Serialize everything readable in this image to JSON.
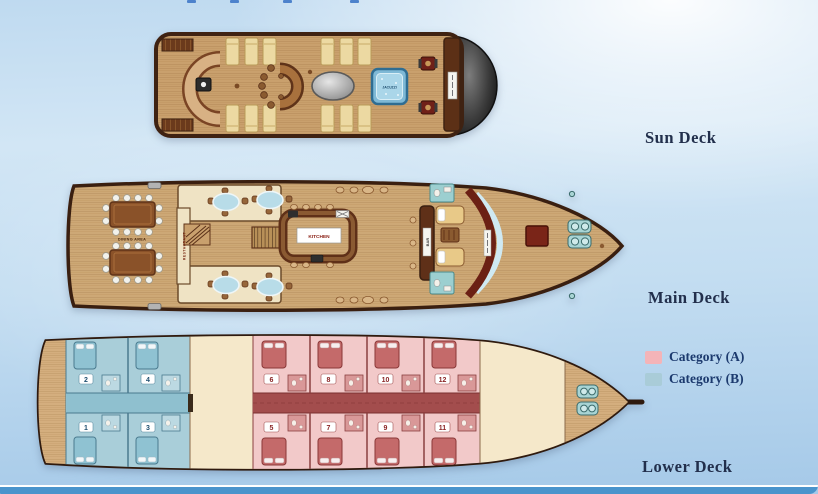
{
  "page": {
    "bottom_bar_color": "#4a94cc",
    "background_top": "#d2e6f5",
    "background_bottom": "#a5c9e8"
  },
  "legend": {
    "items": [
      {
        "label": "Category (A)",
        "color": "#f4b4b8"
      },
      {
        "label": "Category (B)",
        "color": "#a9ccd8"
      }
    ]
  },
  "decks": {
    "sun": {
      "label": "Sun Deck",
      "jacuzzi_label": "JACUZZI"
    },
    "main": {
      "label": "Main Deck",
      "dining_area_label": "DINING AREA",
      "restaurant_label": "RESTAURANT",
      "kitchen_label": "KITCHEN",
      "bar_label": "BAR"
    },
    "lower": {
      "label": "Lower Deck",
      "cabins": [
        {
          "num": "1",
          "category": "B"
        },
        {
          "num": "2",
          "category": "B"
        },
        {
          "num": "3",
          "category": "B"
        },
        {
          "num": "4",
          "category": "B"
        },
        {
          "num": "5",
          "category": "A"
        },
        {
          "num": "6",
          "category": "A"
        },
        {
          "num": "7",
          "category": "A"
        },
        {
          "num": "8",
          "category": "A"
        },
        {
          "num": "9",
          "category": "A"
        },
        {
          "num": "10",
          "category": "A"
        },
        {
          "num": "11",
          "category": "A"
        },
        {
          "num": "12",
          "category": "A"
        }
      ]
    }
  }
}
